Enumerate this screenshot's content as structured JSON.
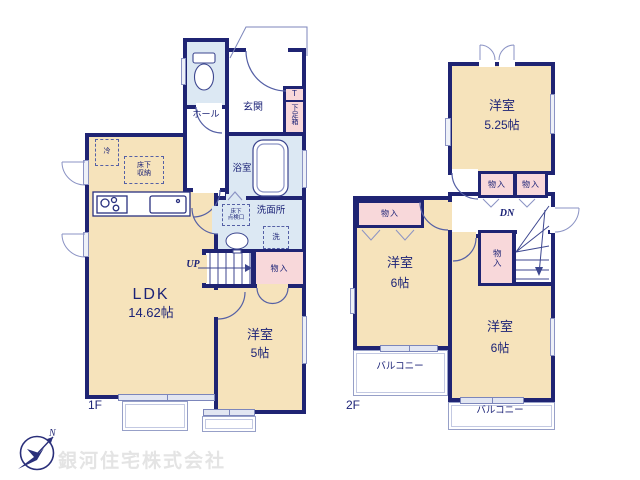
{
  "colors": {
    "wall": "#1f2473",
    "room_fill": "#f6e3bb",
    "wet_room_fill": "#dce8f3",
    "closet_fill": "#f8d8da",
    "thin_line": "#8b93c4",
    "text": "#1c2377",
    "watermark": "#e4e4e4"
  },
  "company": {
    "name": "銀河住宅株式会社",
    "compass_north": "N"
  },
  "floor1": {
    "label": "1F",
    "ldk": {
      "name": "LDK",
      "area": "14.62帖"
    },
    "bedroom": {
      "name": "洋室",
      "area": "5帖"
    },
    "genkan": "玄関",
    "hall": "ホール",
    "bathroom": "浴室",
    "washroom": "洗面所",
    "washer": "洗",
    "fridge": "冷",
    "underfloor_storage": [
      "床下",
      "収納"
    ],
    "inspection_hatch": [
      "床下",
      "点検口"
    ],
    "shoe_box_mark": "T",
    "shoe_box": "下足箱",
    "closet": "物入",
    "stairs": "UP"
  },
  "floor2": {
    "label": "2F",
    "bedroom_a": {
      "name": "洋室",
      "area": "5.25帖"
    },
    "bedroom_b": {
      "name": "洋室",
      "area": "6帖"
    },
    "bedroom_c": {
      "name": "洋室",
      "area": "6帖"
    },
    "closets": [
      "物入",
      "物入",
      "物入",
      "物入"
    ],
    "stairs": "DN",
    "balcony_left": "バルコニー",
    "balcony_right": "バルコニー"
  }
}
